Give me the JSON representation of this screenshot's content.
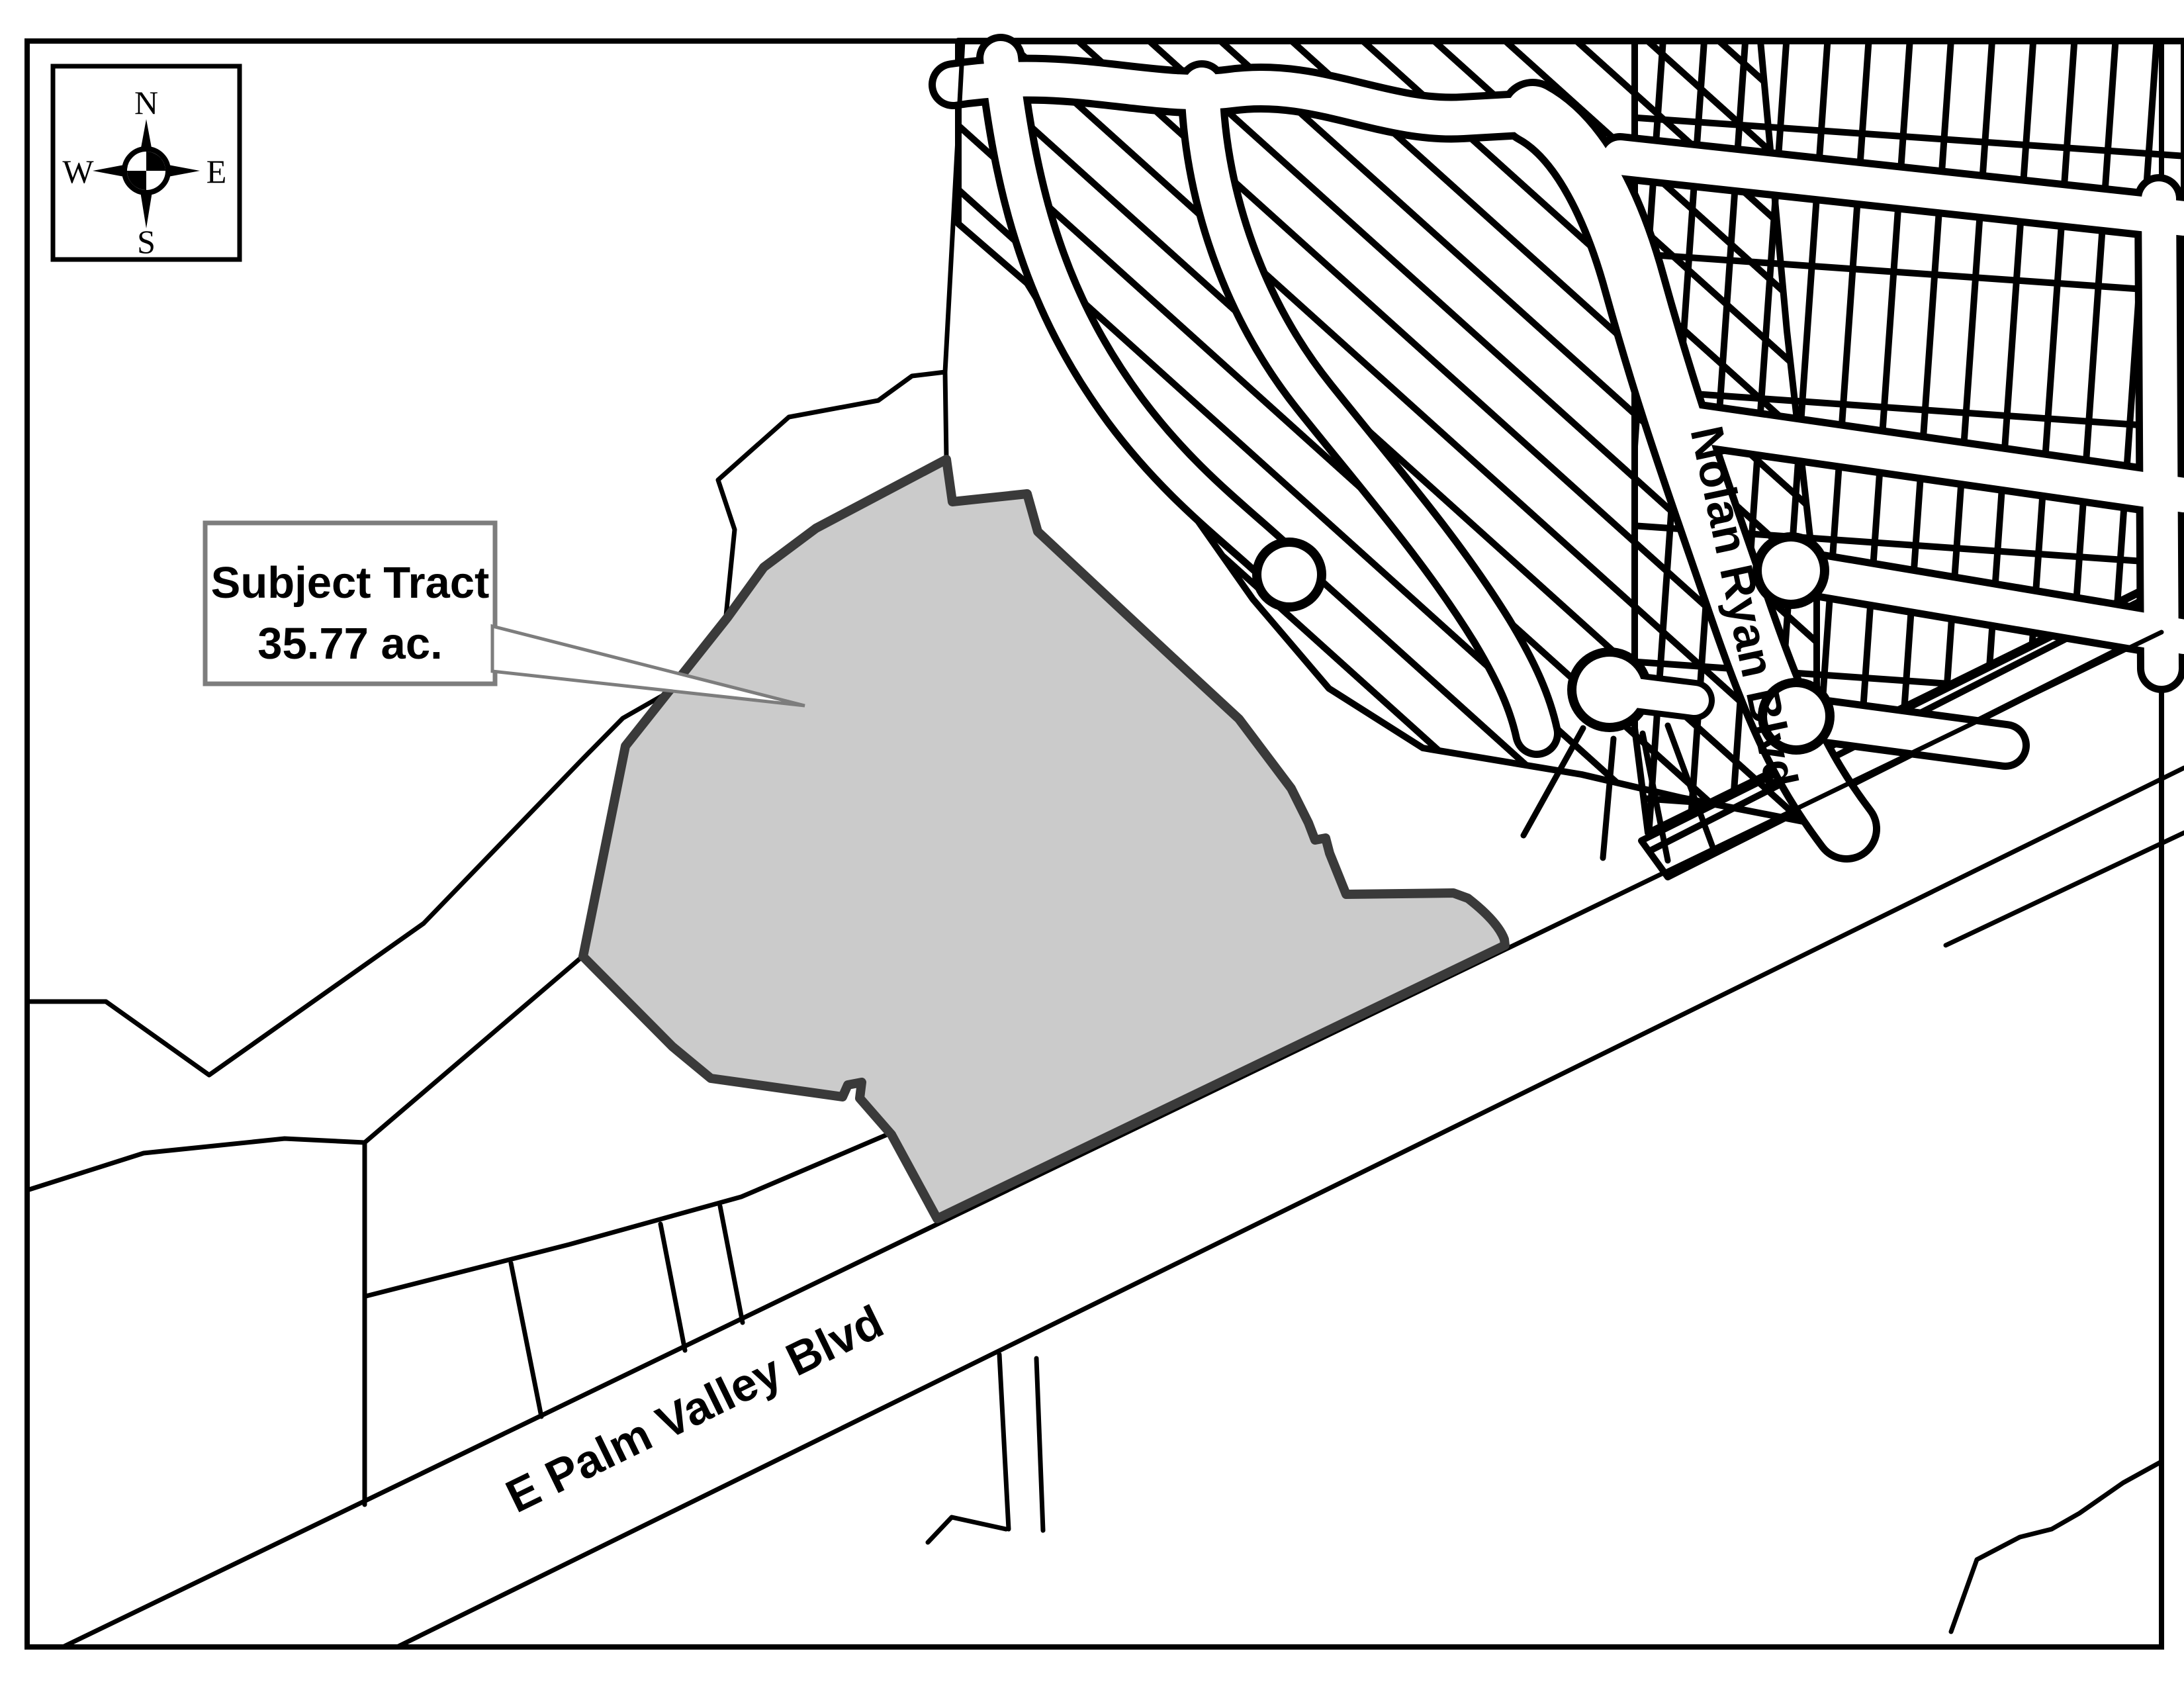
{
  "labels": {
    "callout_line1": "Subject Tract",
    "callout_line2": "35.77 ac.",
    "road_nolan": "Nolan Ryan Blvd",
    "road_palm": "E Palm Valley Blvd"
  },
  "compass": {
    "north": "N",
    "south": "S",
    "east": "E",
    "west": "W"
  },
  "colors": {
    "background": "#ffffff",
    "line": "#000000",
    "tract_fill": "#cbcbcb",
    "tract_border": "#3a3a3a",
    "callout_border": "#7d7d7d"
  }
}
